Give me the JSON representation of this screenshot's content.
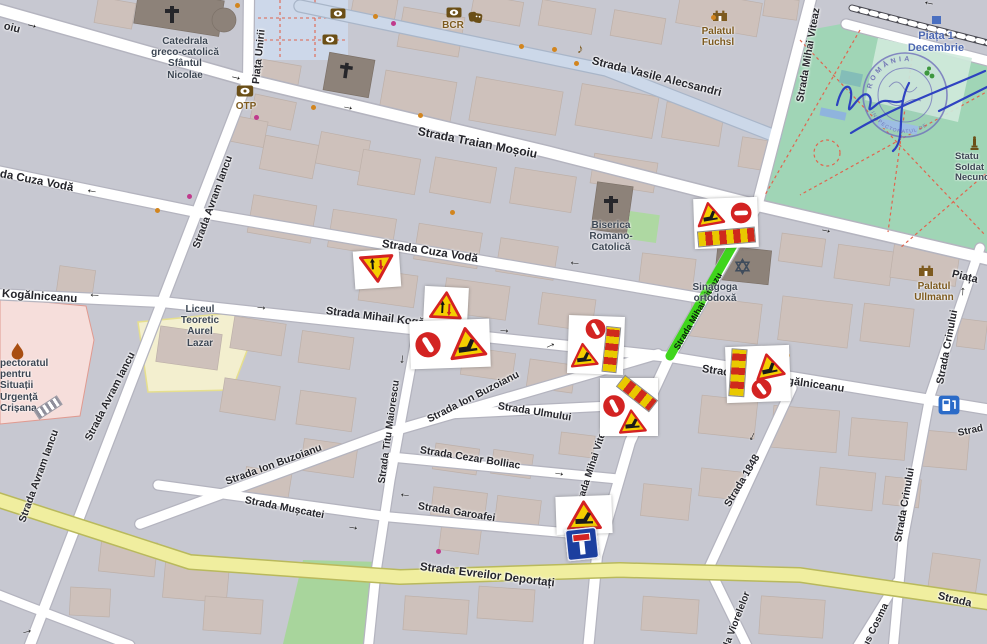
{
  "icons": {
    "arrow": "→",
    "music_note": "♪",
    "icon_names": [
      "bank-icon",
      "theatre-masks-icon",
      "church-cross-icon",
      "castle-icon",
      "star-of-david-icon",
      "flame-icon",
      "statue-icon",
      "fuel-station-icon",
      "one-way-arrow-icon",
      "roadworks-sign-icon",
      "no-entry-sign-icon",
      "stripe-barrier-icon",
      "dead-end-sign-icon",
      "two-way-traffic-sign-icon",
      "oncoming-priority-sign-icon",
      "poi-dot",
      "stamp-seal",
      "signature"
    ]
  },
  "streets": {
    "fragment_mosoiu": "oiu",
    "traian_mosoiu": "Strada Traian Moșoiu",
    "vasile_alecsandri": "Strada Vasile Alecsandri",
    "piata_unirii": "Piața Unirii",
    "mihai_viteaz": "Strada Mihai Viteaz",
    "mihai_viteazu_closed": "Strada Mihai Viteazu",
    "fragment_cuza": "da Cuza Vodă",
    "cuza_voda": "Strada Cuza Vodă",
    "avram_iancu": "Strada Avram Iancu",
    "fragment_kogalniceanu": "Kogălniceanu",
    "mihail_kogalniceanu": "Strada Mihail Kogălniceanu",
    "ion_buzoianu": "Strada Ion Buzoianu",
    "ulmului": "Strada Ulmului",
    "titu_maiorescu": "Strada Titu Maiorescu",
    "cezar_bolliac": "Strada Cezar Bolliac",
    "garoafei": "Strada Garoafei",
    "muscatei": "Strada Mușcatei",
    "strada_1848": "Strada 1848",
    "crinului": "Strada Crinului",
    "fragment_piata": "Piața",
    "evreilor_deportati": "Strada Evreilor Deportați",
    "fragment_strada": "Strada",
    "fragment_strad": "Strad",
    "fragment_viorelelor": "la Viorelelor",
    "fragment_cosma": "ius Cosma"
  },
  "landmarks": {
    "catedrala": {
      "lines": [
        "Catedrala",
        "greco-catolică",
        "Sfântul",
        "Nicolae"
      ]
    },
    "biserica": {
      "lines": [
        "Biserica",
        "Romano-",
        "Catolică"
      ]
    },
    "sinagoga": {
      "lines": [
        "Sinagoga",
        "ortodoxă"
      ]
    },
    "palatul_fuchsl": {
      "lines": [
        "Palatul",
        "Fuchsl"
      ]
    },
    "palatul_ullmann": {
      "lines": [
        "Palatul",
        "Ullmann"
      ]
    },
    "piata_1_decembrie": {
      "lines": [
        "Piața 1",
        "Decembrie"
      ]
    },
    "liceul": {
      "lines": [
        "Liceul",
        "Teoretic",
        "Aurel",
        "Lazar"
      ]
    },
    "inspectoratul": {
      "lines": [
        "pectoratul",
        "pentru",
        "Situații",
        "Urgență",
        "Crișana"
      ]
    },
    "statuia": {
      "lines": [
        "Statu",
        "Soldat",
        "Necuno"
      ]
    },
    "otp": "OTP",
    "bcr": "BCR"
  },
  "stamp": {
    "ring_top": "ROMÂNIA",
    "ring_bottom": "INSPECTORATUL DE"
  },
  "colors": {
    "closed_street_highlight": "#3fd51c",
    "park_green": "#a0d5b6",
    "main_road_yellow": "#f0ee9f",
    "pedestrian_blue": "#cdd8ea",
    "school_cream": "#f3efcf",
    "emergency_pink": "#f6dedb",
    "sign_red": "#d32322",
    "sign_yellow": "#f4cf00",
    "dead_end_blue": "#1c3f9f",
    "label_blue": "#4b66b0",
    "label_brown": "#7d5a1e",
    "stamp_ink_blue": "#2336c0"
  },
  "sign_clusters": [
    {
      "id": "viteazu-north",
      "signs": [
        "roadworks-triangle",
        "no-entry",
        "stripe-barrier"
      ]
    },
    {
      "id": "cuza-voda",
      "signs": [
        "oncoming-priority-triangle"
      ]
    },
    {
      "id": "kogalniceanu-west",
      "signs": [
        "two-way-traffic-triangle"
      ]
    },
    {
      "id": "kogalniceanu-center",
      "signs": [
        "no-entry",
        "roadworks-triangle"
      ]
    },
    {
      "id": "kogalniceanu-viteazu",
      "signs": [
        "no-entry",
        "roadworks-triangle",
        "stripe-barrier"
      ]
    },
    {
      "id": "ulmului-viteaz",
      "signs": [
        "no-entry",
        "stripe-barrier",
        "roadworks-triangle"
      ]
    },
    {
      "id": "kogalniceanu-east",
      "signs": [
        "stripe-barrier",
        "roadworks-triangle",
        "no-entry"
      ]
    },
    {
      "id": "viteaz-south",
      "signs": [
        "roadworks-triangle",
        "dead-end"
      ]
    }
  ]
}
